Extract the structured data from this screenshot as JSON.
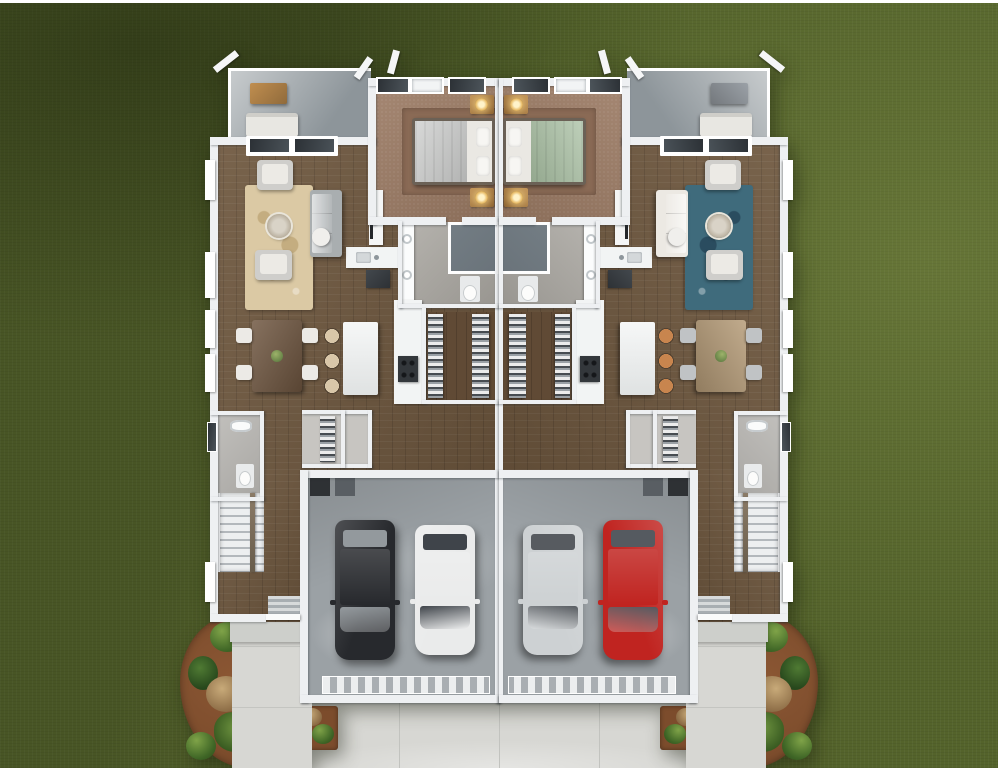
{
  "scene": {
    "description": "Top-down 3D rendering of a mirrored two-unit duplex floor plan on a lawn, with rear patios, two-car garages, front walkways, central driveway and landscaped beds",
    "view": "aerial top-down",
    "background": "green lawn with mowing shade variation",
    "frame": "thin white border line at top edge"
  },
  "building": {
    "layout": "two mirror-image dwelling units sharing a central party wall",
    "units": [
      {
        "name": "left-unit",
        "rooms": [
          "rear patio",
          "bedroom",
          "living room",
          "dining area",
          "kitchen with island",
          "bathroom with double vanity, shower and toilet",
          "walk-in closet",
          "laundry closet",
          "powder room",
          "staircase",
          "entry hall",
          "two-car garage"
        ],
        "furnishings": {
          "patio": "wood table and upholstered bench",
          "bed": "gray bedding with white pillows toward party wall",
          "rug": "beige floral area rug",
          "sofa": "gray sofa with two cream armchairs and round glass coffee table",
          "island_stools": "three beige stools",
          "dining": "dark wood table with four white chairs and plant centerpiece",
          "garage_cars": [
            "black SUV",
            "white car"
          ]
        }
      },
      {
        "name": "right-unit",
        "rooms": [
          "rear patio",
          "bedroom",
          "living room",
          "dining area",
          "kitchen with island",
          "bathroom with double vanity, shower and toilet",
          "walk-in closet",
          "laundry closet",
          "powder room",
          "staircase",
          "entry hall",
          "two-car garage"
        ],
        "furnishings": {
          "patio": "gray grill unit and upholstered bench",
          "bed": "sage-green bedding with white pillows toward party wall",
          "rug": "teal dotted area rug",
          "sofa": "white sofa with gray chairs and round wood coffee table",
          "island_stools": "three orange-tan stools",
          "dining": "light wood table with four gray chairs and gold decor",
          "garage_cars": [
            "silver car",
            "red car"
          ]
        }
      }
    ],
    "exterior": [
      "white roof gable ends at corners",
      "clerestory windows on rear walls",
      "ribbed garage doors",
      "striped entry door mats",
      "concrete front walkways",
      "central concrete driveway with expansion joints",
      "mulched garden beds with green and dry shrubs",
      "small square planters flanking the driveway"
    ]
  },
  "palette": {
    "grass": "#54632b",
    "wall": "#eef0f2",
    "wood": "#6f583f",
    "wood-dark": "#604a35",
    "carpet": "#9c7b64",
    "carpet-dark": "#8a6a55",
    "bath-floor": "#aaa7a1",
    "shower": "#6a737a",
    "concrete": "#d7d7d3",
    "garage-floor": "#9ba1a5",
    "mulch": "#7c4c2c",
    "rug-left": "#dbc9a4",
    "rug-left-dot": "#c4ad80",
    "rug-right": "#3f6b7c",
    "rug-right-dot": "#2a4c5f",
    "sofa-left": "#a9aeb0",
    "sofa-right": "#ece9e3",
    "bed-left": "#cbcccb",
    "bed-right": "#a8bfa2",
    "stool-left": "#d9c7a9",
    "stool-right": "#c8854e",
    "table-left": "#6f5640",
    "table-right": "#b59b77",
    "chair-left": "#eceae6",
    "chair-right": "#c0c3c5",
    "patio-table-left": "#c08e4f",
    "patio-table-right": "#9ba1a7",
    "car-a-left": "#27292d",
    "car-a-left-glass": "#93999d",
    "car-b-left": "#eaebeb",
    "car-b-left-glass": "#3f444a",
    "car-a-right": "#c02420",
    "car-a-right-glass": "#555a60",
    "car-b-right": "#cdd1d3",
    "car-b-right-glass": "#575b60",
    "lamp": "#e9bd6a",
    "white": "#ffffff"
  }
}
